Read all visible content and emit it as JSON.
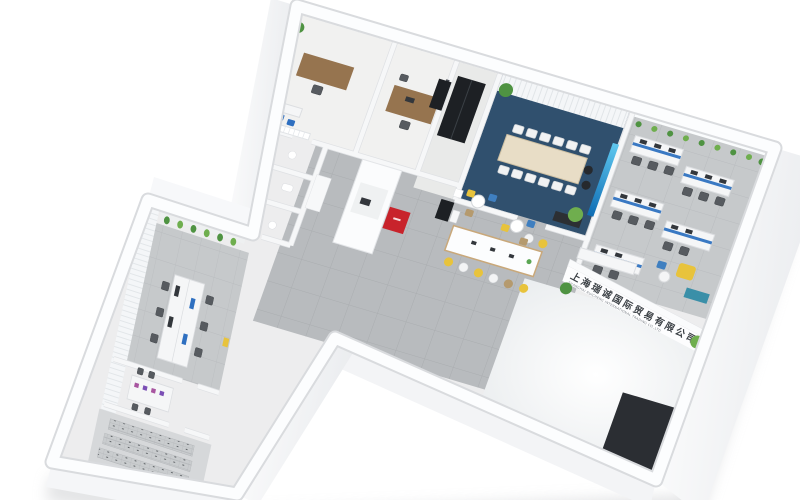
{
  "scene": {
    "title": "3D axonometric office floor plan render",
    "background": "#ffffff"
  },
  "company_sign": {
    "line1": "上海瑞诚国际贸易有限公司",
    "line2": "SHANGHAI RUICHENG INTERNATIONAL TRADING CO.,LTD"
  },
  "palette": {
    "wallWhite": "#fbfcfd",
    "wallEdge": "#d9dbde",
    "floorBase": "#ededee",
    "hallTile": "#b8bbbe",
    "carpetGrey": "#c6c9cb",
    "navyCarpet": "#30506e",
    "screenBlue": "#17a4dd",
    "logoRed": "#c8232b",
    "accentYellow": "#e8c33c",
    "accentBlue": "#3f7fc0",
    "tealCabinet": "#3a8fa8",
    "purpleAccent": "#a855a0",
    "plantGreen": "#4f9342",
    "woodDesk": "#96744f",
    "tableTop": "#e8ddc6",
    "matDark": "#2b2e33",
    "chairGrey": "#575b60",
    "entranceGloss": "#f0f2f4"
  },
  "rooms": [
    {
      "id": "executive-office",
      "label": "executive office"
    },
    {
      "id": "manager-office",
      "label": "manager office"
    },
    {
      "id": "storage-nook",
      "label": "black cabinet storage"
    },
    {
      "id": "conference-room",
      "label": "conference room"
    },
    {
      "id": "open-office",
      "label": "open plan office"
    },
    {
      "id": "reception-hall",
      "label": "reception hall"
    },
    {
      "id": "break-bar",
      "label": "bar island break area"
    },
    {
      "id": "restrooms",
      "label": "restroom cells"
    },
    {
      "id": "wing-office",
      "label": "left wing team office"
    },
    {
      "id": "wing-room",
      "label": "left wing small office"
    },
    {
      "id": "archive-storage",
      "label": "archive shelving room"
    },
    {
      "id": "entrance",
      "label": "entrance lobby"
    }
  ]
}
